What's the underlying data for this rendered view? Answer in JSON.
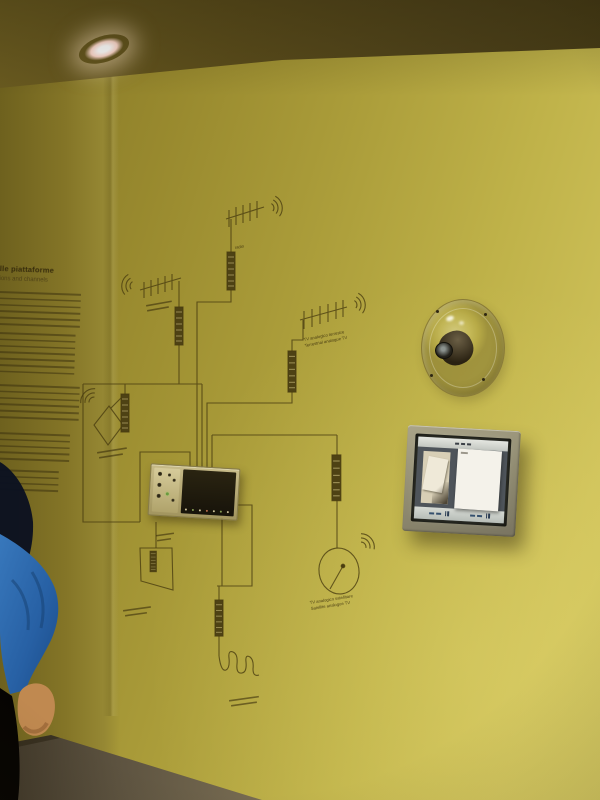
{
  "scene": {
    "subjects": [
      "exhibit-wall-diagram",
      "touchscreen-kiosk",
      "acrylic-dome-device",
      "visitor-arm",
      "ceiling-spotlight"
    ]
  },
  "wall_panel": {
    "title_fragment": "lle piattaforme",
    "subtitle_fragment": "ions and channels"
  },
  "diagram": {
    "labels": {
      "top_antenna": "radio",
      "terrestrial_line1": "TV analogico terrestre",
      "terrestrial_line2": "Terrestrial analogue TV",
      "satellite_line1": "TV analogico satellitare",
      "satellite_line2": "Satellite analogue TV"
    },
    "symbols": [
      "yagi-antenna",
      "loop-antenna",
      "satellite-dish",
      "amplifier",
      "radio-waves",
      "sine-wave",
      "receiver-unit"
    ]
  },
  "kiosk": {
    "icons": [
      "pause-icon",
      "pause-icon"
    ]
  },
  "colors": {
    "wall": "#b2a43c",
    "ceiling": "#4e421a",
    "diagram_ink": "#4a3d10",
    "kiosk_frame": "#8f8a70",
    "kiosk_screen_dark": "#4e545a",
    "kiosk_bar_light": "#d6dad4",
    "kiosk_accent": "#2c3e55",
    "receiver_plate": "#b7ab72",
    "led_green": "#6a9a40",
    "floor": "#6b604b",
    "sleeve_blue": "#2e6cb0",
    "hand_skin": "#c08950"
  }
}
